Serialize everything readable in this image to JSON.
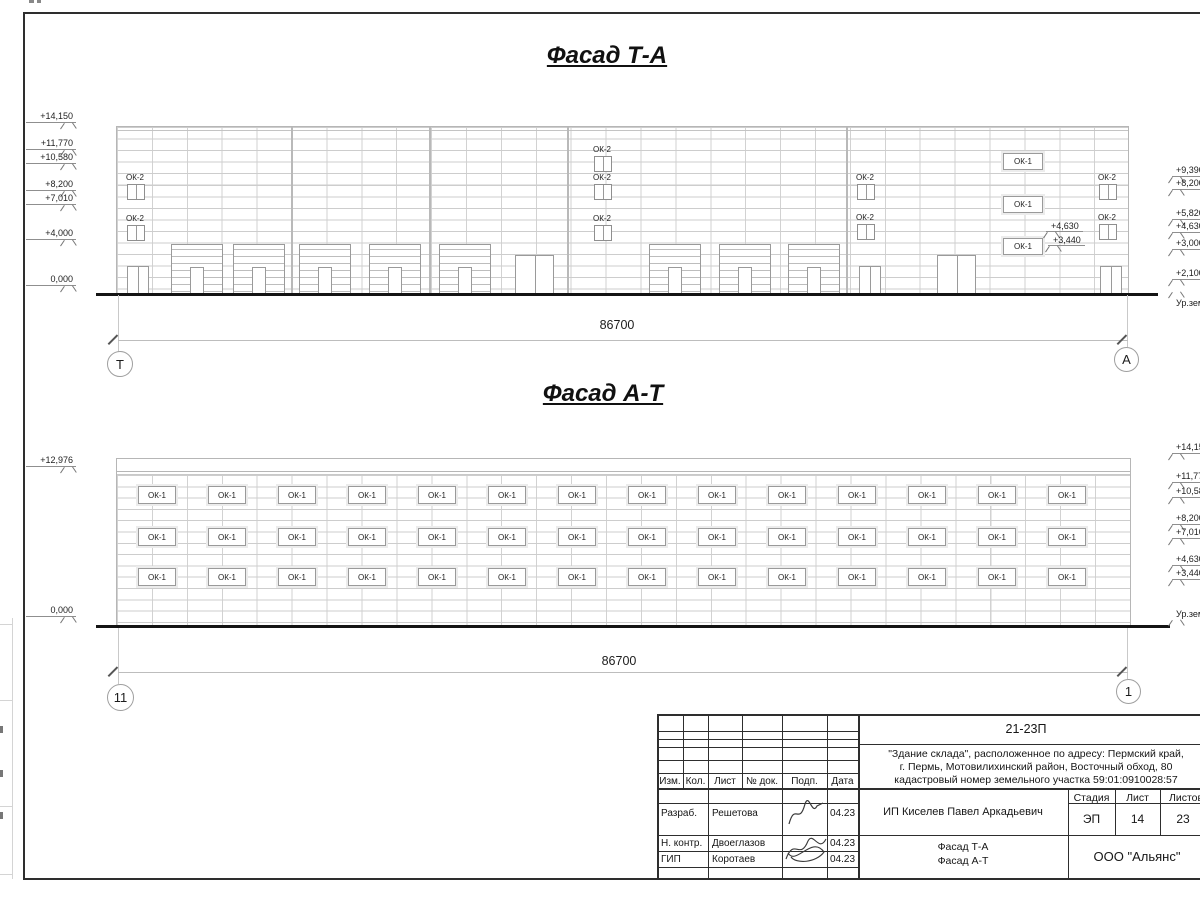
{
  "colors": {
    "background": "#ffffff",
    "grid_line": "#cdcdcd",
    "dark_line": "#2e2e2e",
    "text": "#1c1c1c",
    "ground_line": "#141414"
  },
  "sheet": {
    "facade_ta": {
      "title": "Фасад Т-А",
      "dimension": "86700",
      "axis_left": "Т",
      "axis_right": "А",
      "small_window_label": "ОК-2",
      "wide_window_label": "ОК-1",
      "left_marks": [
        {
          "text": "+14,150",
          "y": 122
        },
        {
          "text": "+11,770",
          "y": 149
        },
        {
          "text": "+10,580",
          "y": 163
        },
        {
          "text": "+8,200",
          "y": 190
        },
        {
          "text": "+7,010",
          "y": 204
        },
        {
          "text": "+4,000",
          "y": 239
        },
        {
          "text": "0,000",
          "y": 285
        }
      ],
      "right_marks": [
        {
          "text": "+9,390",
          "y": 176
        },
        {
          "text": "+8,200",
          "y": 189
        },
        {
          "text": "+5,820",
          "y": 219
        },
        {
          "text": "+4,630",
          "y": 232
        },
        {
          "text": "+3,000",
          "y": 249
        },
        {
          "text": "+2,100",
          "y": 279
        },
        {
          "text": "Ур.зем.",
          "y": 298,
          "ground": true,
          "flag": "above"
        }
      ],
      "inner_marks": [
        {
          "text": "+4,630",
          "x": 1046,
          "y": 231
        },
        {
          "text": "+3,440",
          "x": 1048,
          "y": 245
        }
      ]
    },
    "facade_at": {
      "title": "Фасад А-Т",
      "dimension": "86700",
      "axis_left": "11",
      "axis_right": "1",
      "window_label": "ОК-1",
      "window_rows": 3,
      "windows_per_row": 14,
      "left_marks": [
        {
          "text": "+12,976",
          "y": 466
        },
        {
          "text": "0,000",
          "y": 616
        }
      ],
      "right_marks": [
        {
          "text": "+14,150",
          "y": 453
        },
        {
          "text": "+11,770",
          "y": 482
        },
        {
          "text": "+10,580",
          "y": 497
        },
        {
          "text": "+8,200",
          "y": 524
        },
        {
          "text": "+7,010",
          "y": 538
        },
        {
          "text": "+4,630",
          "y": 565
        },
        {
          "text": "+3,440",
          "y": 579
        },
        {
          "text": "Ур.зем.",
          "y": 609,
          "ground": true,
          "flag": "below"
        }
      ]
    },
    "title_block": {
      "project_code": "21-23П",
      "object_text_lines": [
        "\"Здание склада\", расположенное по адресу: Пермский край,",
        "г. Пермь, Мотовилихинский район, Восточный обход, 80",
        "кадастровый номер земельного участка 59:01:0910028:57"
      ],
      "header_cols": [
        "Изм.",
        "Кол.",
        "Лист",
        "№ док.",
        "Подп.",
        "Дата"
      ],
      "signature_rows": [
        {
          "role": "Разраб.",
          "name": "Решетова",
          "date": "04.23"
        },
        {
          "role": "Н. контр.",
          "name": "Двоеглазов",
          "date": "04.23"
        },
        {
          "role": "ГИП",
          "name": "Коротаев",
          "date": "04.23"
        }
      ],
      "client": "ИП Киселев Павел Аркадьевич",
      "stage_label": "Стадия",
      "sheet_label": "Лист",
      "sheets_label": "Листов",
      "stage": "ЭП",
      "sheet_number": "14",
      "sheets_total": "23",
      "doc_title_lines": [
        "Фасад Т-А",
        "Фасад А-Т"
      ],
      "company": "ООО \"Альянс\""
    }
  }
}
